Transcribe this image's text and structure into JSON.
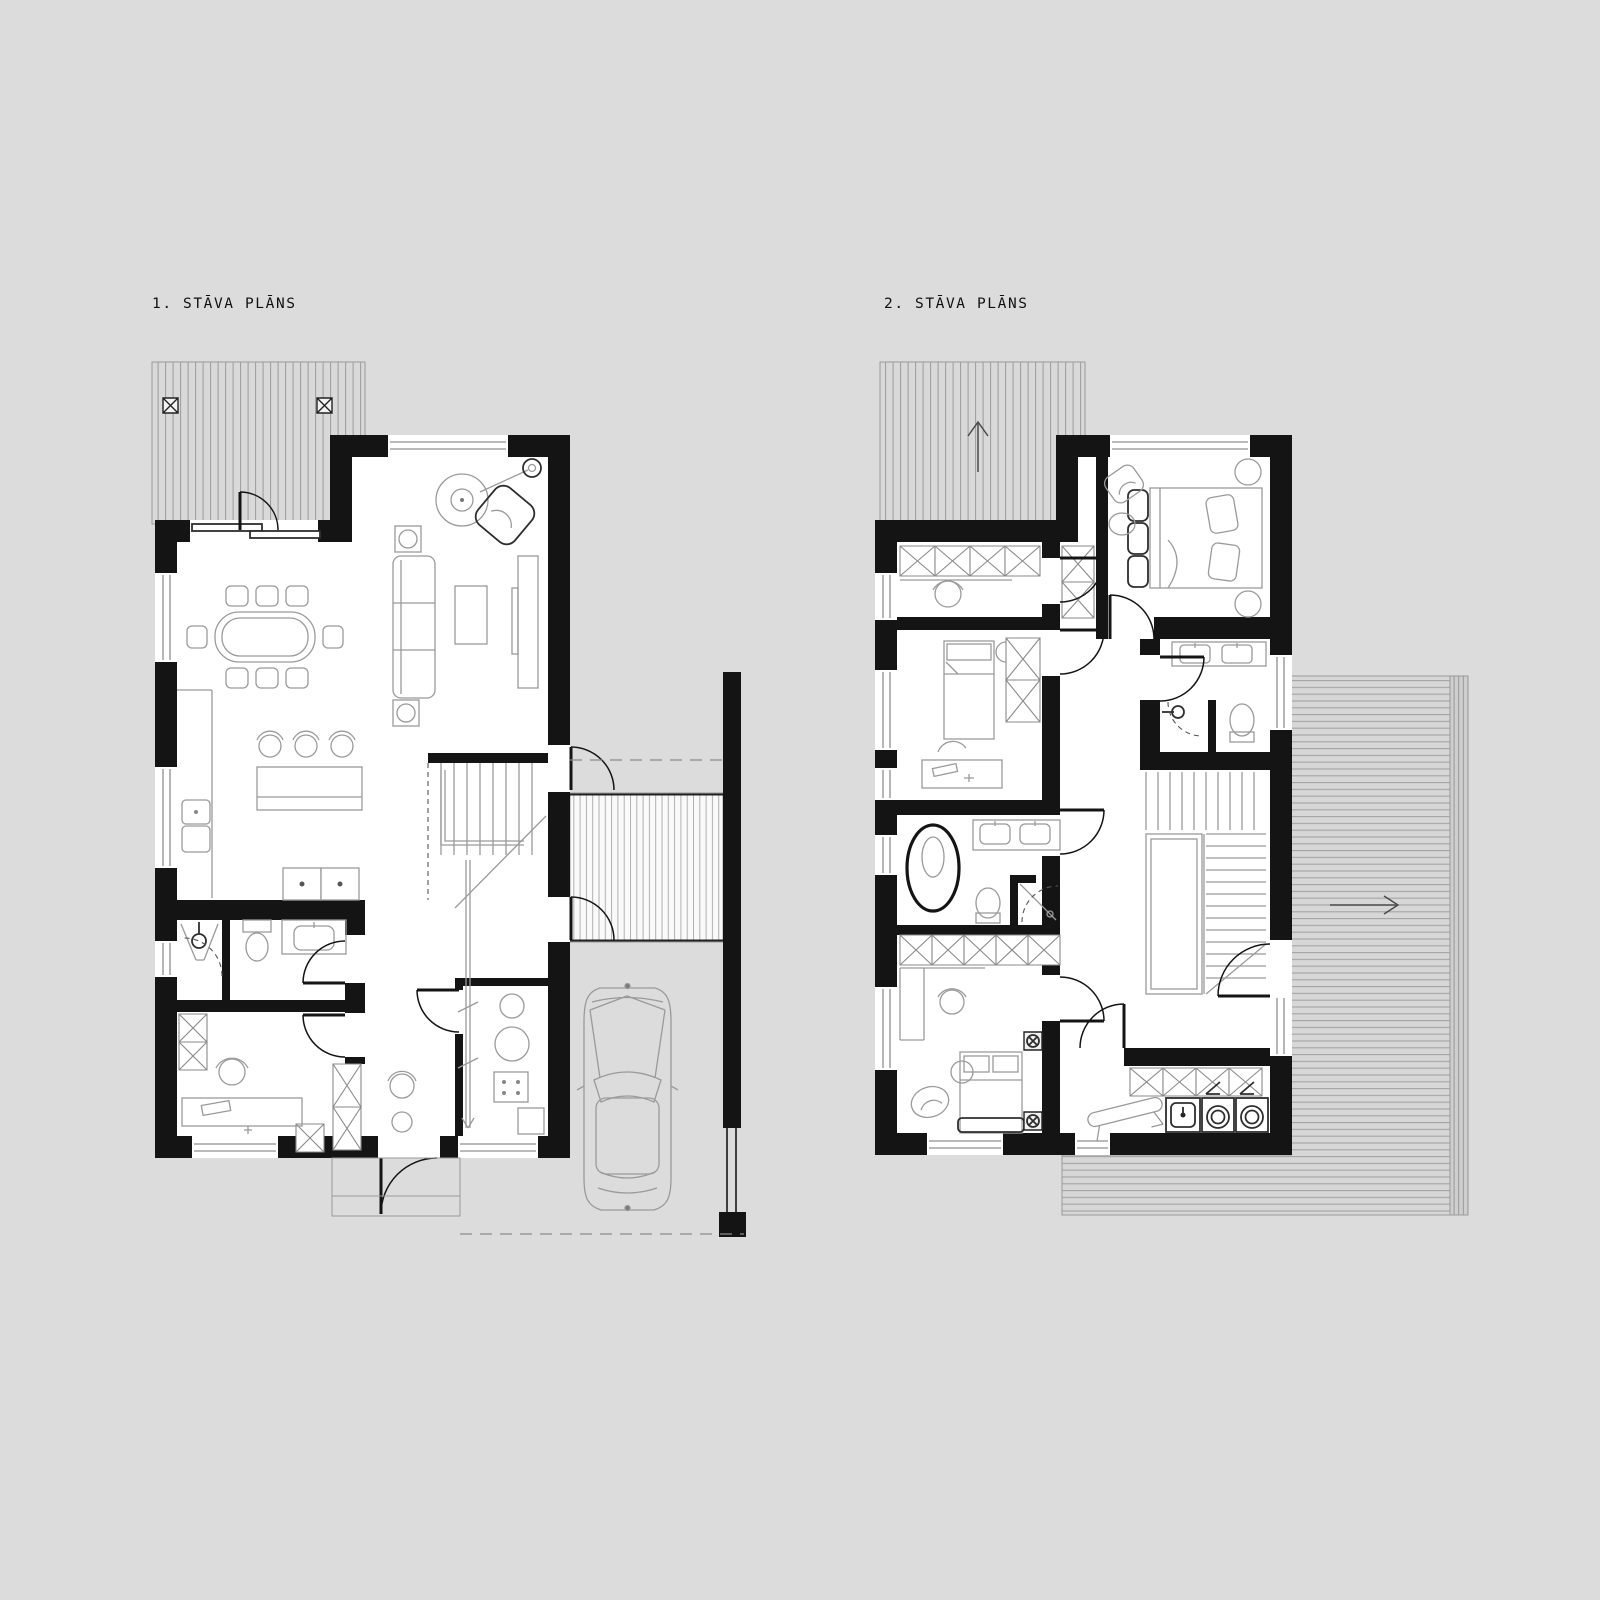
{
  "sheet": {
    "background": "#dcdcdc",
    "type": "architectural-floor-plans"
  },
  "plans": [
    {
      "title": "1. STĀVA PLĀNS"
    },
    {
      "title": "2. STĀVA PLĀNS"
    }
  ],
  "colors": {
    "background": "#dcdcdc",
    "wall": "#141414",
    "room_fill": "#ffffff",
    "furniture_line": "#9a9a9a",
    "dark_fixture_line": "#2e2e2e",
    "terrace_fill": "#d9d9d9",
    "terrace_line": "#9c9c9c",
    "entry_deck_fill": "#fafafa"
  },
  "icons": {
    "north_arrow": "up-arrow",
    "terrace_direction_arrow": "right-arrow",
    "terrace_posts": "x-square"
  }
}
